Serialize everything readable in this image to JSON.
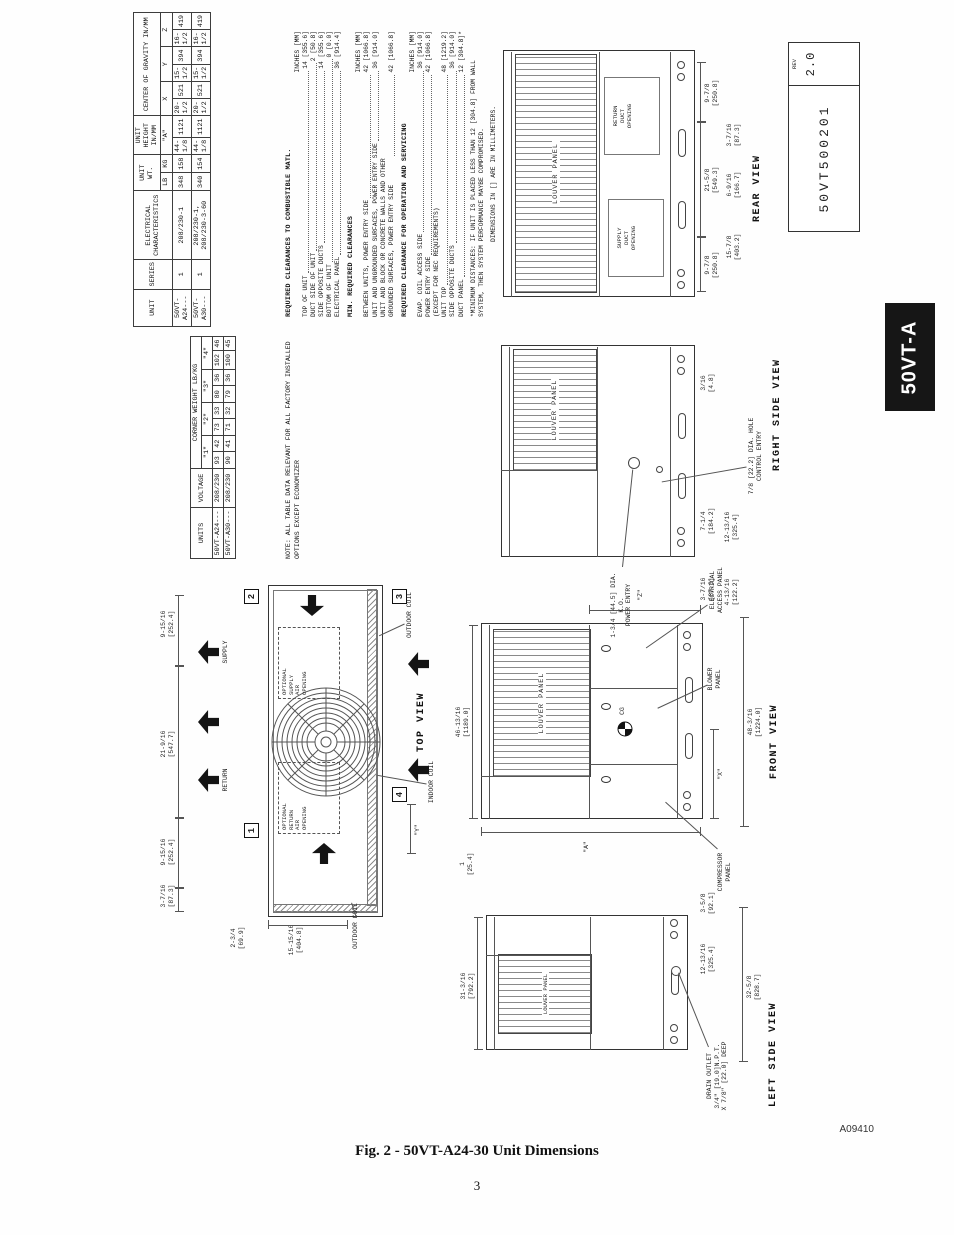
{
  "page": {
    "tab_label": "50VT-A",
    "drawing_number": "50VT500201",
    "rev_label": "REV",
    "rev_value": "2.0",
    "image_code": "A09410",
    "figure_caption": "Fig. 2 - 50VT-A24-30 Unit Dimensions",
    "page_number": "3"
  },
  "tables": {
    "main": {
      "h_unit": "UNIT",
      "h_series": "SERIES",
      "h_electrical": "ELECTRICAL\nCHARACTERISTICS",
      "h_unit_wt": "UNIT WT.",
      "h_lb": "LB",
      "h_kg": "KG",
      "h_height": "UNIT HEIGHT IN/MM",
      "h_a": "\"A\"",
      "h_cog": "CENTER OF GRAVITY IN/MM",
      "h_x": "X",
      "h_y": "Y",
      "h_z": "Z",
      "rows": [
        [
          "50VT-A24---",
          "1",
          "208/230-1",
          "348",
          "158",
          "44-1/8",
          "1121",
          "20-1/2",
          "521",
          "15-1/2",
          "394",
          "16-1/2",
          "419"
        ],
        [
          "50VT-A30---",
          "1",
          "208/230-1, 208/230-3-60",
          "340",
          "154",
          "44-1/8",
          "1121",
          "20-1/2",
          "521",
          "15-1/2",
          "394",
          "16-1/2",
          "419"
        ]
      ]
    },
    "corner": {
      "h_units": "UNITS",
      "h_voltage": "VOLTAGE",
      "h_title": "CORNER WEIGHT LB/KG",
      "h_c1": "\"1\"",
      "h_c2": "\"2\"",
      "h_c3": "\"3\"",
      "h_c4": "\"4\"",
      "rows": [
        [
          "50VT-A24---",
          "208/230",
          "93",
          "42",
          "73",
          "33",
          "80",
          "36",
          "102",
          "46"
        ],
        [
          "50VT-A30---",
          "208/230",
          "90",
          "41",
          "71",
          "32",
          "79",
          "36",
          "100",
          "45"
        ]
      ]
    },
    "note": "NOTE:  ALL TABLE DATA RELEVANT FOR ALL FACTORY INSTALLED\n           OPTIONS EXCEPT ECONOMIZER"
  },
  "clearances": {
    "combustible": {
      "title": "REQUIRED CLEARANCES TO COMBUSTIBLE MATL.",
      "units": "INCHES [MM]",
      "items": [
        {
          "label": "TOP OF UNIT",
          "value": "14 [355.6]"
        },
        {
          "label": "DUCT SIDE OF UNIT",
          "value": "2 [50.8]"
        },
        {
          "label": "SIDE OPPOSITE DUCTS",
          "value": "14 [355.6]"
        },
        {
          "label": "BOTTOM OF UNIT",
          "value": "0 [0.0]"
        },
        {
          "label": "ELECTRICAL PANEL",
          "value": "36 [914.4]"
        }
      ]
    },
    "min_required": {
      "title": "MIN. REQUIRED CLEARANCES",
      "units": "INCHES [MM]",
      "items": [
        {
          "label": "BETWEEN UNITS, POWER ENTRY SIDE",
          "value": "42 [1066.8]"
        },
        {
          "label": "UNIT AND UNGROUNDED SURFACES, POWER ENTRY SIDE",
          "value": "36 [914.0]"
        },
        {
          "label": "UNIT AND BLOCK OR CONCRETE WALLS AND OTHER\nGROUNDED SURFACES, POWER ENTRY SIDE",
          "value": "42 [1066.8]"
        }
      ]
    },
    "operation": {
      "title": "REQUIRED CLEARANCE FOR OPERATION AND SERVICING",
      "units": "INCHES [MM]",
      "items": [
        {
          "label": "EVAP. COIL ACCESS SIDE",
          "value": "36 [914.0]"
        },
        {
          "label": "POWER ENTRY SIDE",
          "value": "42 [1066.8]"
        },
        {
          "label": "(EXCEPT FOR NEC REQUIREMENTS)",
          "value": ""
        },
        {
          "label": "UNIT TOP",
          "value": "48 [1219.2]"
        },
        {
          "label": "SIDE OPPOSITE DUCTS",
          "value": "36 [914.0]"
        },
        {
          "label": "DUCT PANEL",
          "value": "12 [304.8]*"
        }
      ]
    },
    "footnote": "*MINIMUM DISTANCES: IF UNIT IS PLACED LESS THAN 12 [304.8] FROM WALL\n  SYSTEM, THEN SYSTEM PERFORMANCE MAYBE COMPROMISED.",
    "mm_note": "DIMENSIONS IN [] ARE IN MILLIMETERS."
  },
  "views": {
    "top": {
      "title": "TOP VIEW",
      "supply": "SUPPLY",
      "return": "RETURN",
      "optional_supply": "OPTIONAL\nSUPPLY\nAIR\nOPENING",
      "optional_return": "OPTIONAL\nRETURN\nAIR\nOPENING",
      "outdoor_coil_a": "OUTDOOR COIL",
      "outdoor_coil_b": "OUTDOOR COIL",
      "indoor_coil": "INDOOR COIL",
      "corner_markers": [
        "1",
        "2",
        "3",
        "4"
      ],
      "d87": "3-7/16\n[87.3]",
      "d252a": "9-15/16\n[252.4]",
      "d547": "21-9/16\n[547.7]",
      "d252b": "9-15/16\n[252.4]",
      "d69": "2-3/4\n[69.9]",
      "d404": "15-15/16\n[404.8]",
      "dy": "\"Y\""
    },
    "front": {
      "title": "FRONT VIEW",
      "louver": "LOUVER PANEL",
      "electrical": "ELECTRICAL\nACCESS PANEL",
      "blower": "BLOWER\nPANEL",
      "compressor": "COMPRESSOR\nPANEL",
      "cg": "CG",
      "d1189": "46-13/16\n[1189.0]",
      "d1224": "48-3/16\n[1224.0]",
      "d25": "1\n[25.4]",
      "da": "\"A\"",
      "dx": "\"X\"",
      "dz": "\"Z\""
    },
    "rear": {
      "title": "REAR VIEW",
      "louver": "LOUVER PANEL",
      "supply_duct": "SUPPLY\nDUCT\nOPENING",
      "return_duct": "RETURN\nDUCT\nOPENING",
      "d250a": "9-7/8\n[250.8]",
      "d549": "21-5/8\n[549.3]",
      "d250b": "9-7/8\n[250.8]",
      "d403": "15-7/8\n[403.2]",
      "d166": "6-9/16\n[166.7]",
      "d87": "3-7/16\n[87.3]"
    },
    "right": {
      "title": "RIGHT SIDE VIEW",
      "louver": "LOUVER PANEL",
      "power_entry": "1-3/4 [44.5] DIA. K.O.\nPOWER ENTRY",
      "control_entry": "7/8 [22.2] DIA. HOLE\nCONTROL ENTRY",
      "d4": "3/16\n[4.8]",
      "d184": "7-1/4\n[184.2]",
      "d325": "12-13/16\n[325.4]",
      "d87": "3-7/16\n[87.3]",
      "d122": "4-13/16\n[122.2]"
    },
    "left": {
      "title": "LEFT SIDE VIEW",
      "louver": "LOUVER PANEL",
      "drain": "DRAIN OUTLET\n3/4\" [19.0]N.P.T.\nX 7/8\" [22.0] DEEP",
      "d792": "31-3/16\n[792.2]",
      "d325": "12-13/16\n[325.4]",
      "d828": "32-5/8\n[828.7]",
      "d92": "3-5/8\n[92.1]"
    }
  }
}
